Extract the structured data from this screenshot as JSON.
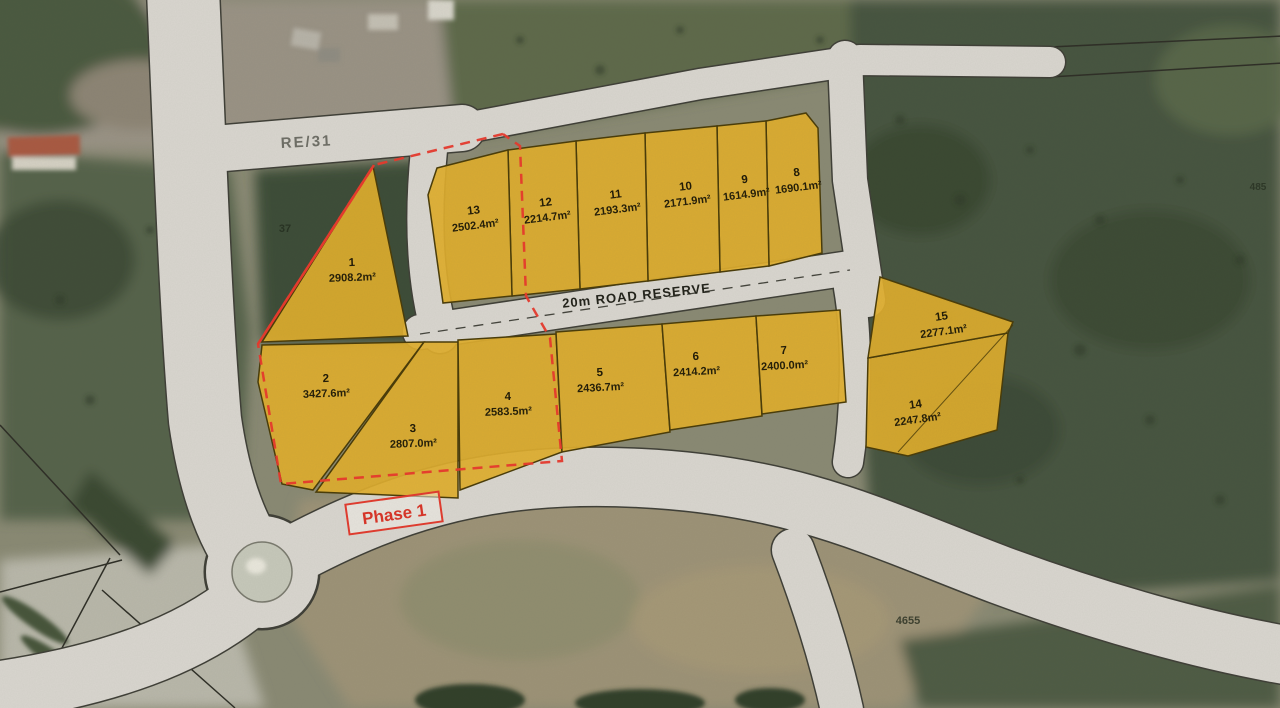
{
  "map": {
    "region_labels": {
      "re31": "RE/31",
      "road_reserve": "20m ROAD RESERVE",
      "phase": "Phase 1"
    },
    "faint_labels": [
      {
        "text": "37",
        "x": 285,
        "y": 232,
        "size": 11,
        "opacity": 0.65
      },
      {
        "text": "4655",
        "x": 908,
        "y": 624,
        "size": 11,
        "opacity": 0.75
      },
      {
        "text": "485",
        "x": 1258,
        "y": 190,
        "size": 10,
        "opacity": 0.6
      }
    ],
    "lots": [
      {
        "id": "1",
        "area": "2908.2m²",
        "poly": "373,166 408,336 262,342",
        "lx": 352,
        "ly": 266,
        "rot": -2
      },
      {
        "id": "2",
        "area": "3427.6m²",
        "poly": "262,345 424,342 313,490 282,484 258,382",
        "lx": 326,
        "ly": 382,
        "rot": -2
      },
      {
        "id": "3",
        "area": "2807.0m²",
        "poly": "424,342 458,342 458,498 316,492",
        "lx": 413,
        "ly": 432,
        "rot": -2
      },
      {
        "id": "4",
        "area": "2583.5m²",
        "poly": "458,340 556,334 562,452 460,490",
        "lx": 508,
        "ly": 400,
        "rot": -2
      },
      {
        "id": "5",
        "area": "2436.7m²",
        "poly": "556,332 662,324 670,432 562,452",
        "lx": 600,
        "ly": 376,
        "rot": -3
      },
      {
        "id": "6",
        "area": "2414.2m²",
        "poly": "662,324 756,316 762,416 670,430",
        "lx": 696,
        "ly": 360,
        "rot": -3
      },
      {
        "id": "7",
        "area": "2400.0m²",
        "poly": "756,316 840,310 846,402 762,414",
        "lx": 784,
        "ly": 354,
        "rot": -3
      },
      {
        "id": "8",
        "area": "1690.1m²",
        "poly": "766,121 806,113 818,128 822,253 769,266",
        "lx": 797,
        "ly": 176,
        "rot": -7
      },
      {
        "id": "9",
        "area": "1614.9m²",
        "poly": "717,126 766,121 769,266 720,272",
        "lx": 745,
        "ly": 183,
        "rot": -7
      },
      {
        "id": "10",
        "area": "2171.9m²",
        "poly": "645,133 717,126 720,272 648,281",
        "lx": 686,
        "ly": 190,
        "rot": -7
      },
      {
        "id": "11",
        "area": "2193.3m²",
        "poly": "576,141 645,133 648,281 580,289",
        "lx": 616,
        "ly": 198,
        "rot": -7
      },
      {
        "id": "12",
        "area": "2214.7m²",
        "poly": "508,150 576,141 580,289 512,296",
        "lx": 546,
        "ly": 206,
        "rot": -7
      },
      {
        "id": "13",
        "area": "2502.4m²",
        "poly": "437,168 508,150 512,296 443,303 428,195",
        "lx": 474,
        "ly": 214,
        "rot": -7
      },
      {
        "id": "14",
        "area": "2247.8m²",
        "poly": "868,358 1008,333 997,430 908,456 866,447",
        "lx": 916,
        "ly": 408,
        "rot": -8
      },
      {
        "id": "15",
        "area": "2277.1m²",
        "poly": "880,277 1013,322 1008,333 868,358",
        "lx": 942,
        "ly": 320,
        "rot": -8
      }
    ],
    "colors": {
      "lot_fill": "#dfae2c",
      "lot_stroke": "#4a3c08",
      "phase_red": "#e8392c",
      "road_gray": "#d9d6cf",
      "label_dark": "#201a06"
    }
  }
}
